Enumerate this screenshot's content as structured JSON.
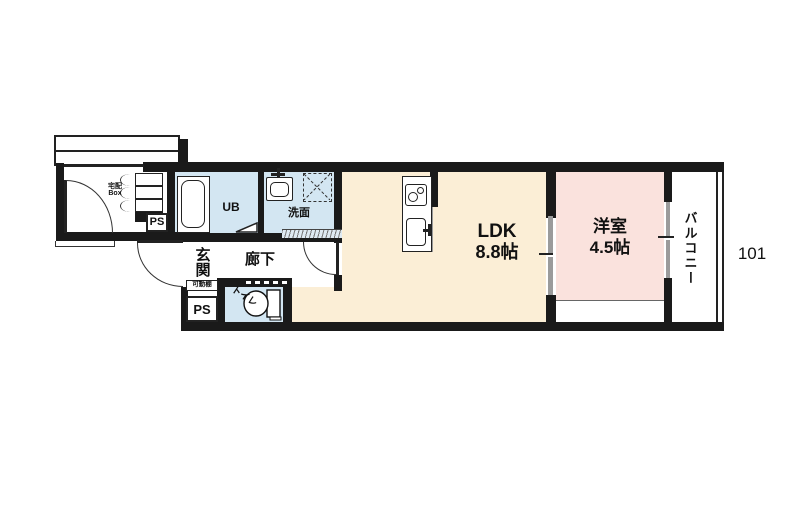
{
  "unit_number": "101",
  "rooms": {
    "ldk": {
      "label": "LDK",
      "size": "8.8帖"
    },
    "bedroom": {
      "label": "洋室",
      "size": "4.5帖"
    },
    "balcony": {
      "label": "バルコニー"
    },
    "entrance": {
      "label": "玄関"
    },
    "corridor": {
      "label": "廊下"
    },
    "toilet": {
      "label": "トイレ"
    },
    "washroom": {
      "label": "洗面"
    },
    "unit_bath": {
      "label": "UB"
    }
  },
  "fixtures": {
    "delivery_box": {
      "line1": "宅配",
      "line2": "Box"
    },
    "movable_shelf": {
      "label": "可動棚"
    },
    "pipe_space_left": {
      "label": "PS"
    },
    "pipe_space_entrance": {
      "label": "PS"
    }
  },
  "colors": {
    "wall": "#1a1a1a",
    "ldk_fill": "#fbeed6",
    "bedroom_fill": "#fae2dd",
    "wet_area_fill": "#d3e6f2",
    "door_panel": "#9b9b9b"
  }
}
